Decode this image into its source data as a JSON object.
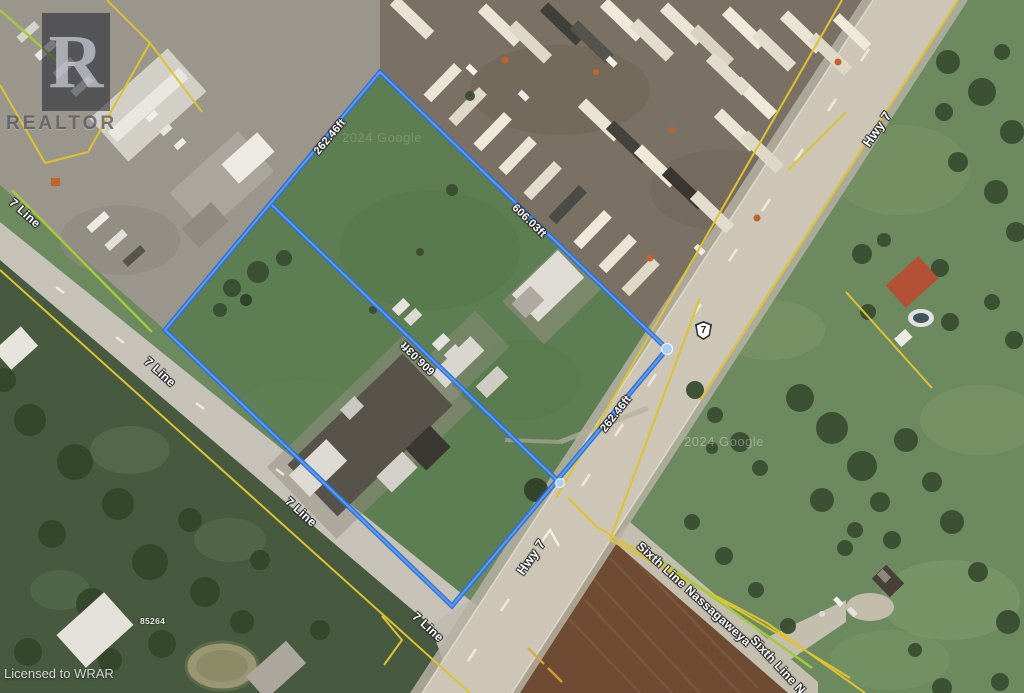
{
  "watermarks": {
    "realtor_letter": "R",
    "realtor": "REALTOR",
    "licensed": "Licensed to WRAR",
    "google": "2024 Google"
  },
  "roads": {
    "hwy7": "Hwy 7",
    "line7": "7 Line",
    "sixth_line": "Sixth Line Nassagaweya",
    "sixth_line_cut": "Sixth Line N",
    "shield": "7"
  },
  "measurements": {
    "nw_edge": "262.46ft",
    "ne_edge": "606.03ft",
    "interior": "606.03ft",
    "hwy_edge": "262.46ft"
  },
  "parcel": {
    "address": "85264"
  },
  "colors": {
    "boundary_blue": "#3B7DE2",
    "boundary_vertex": "#AECDF0",
    "parcel_yellow": "#DDC232",
    "parcel_green": "#A4C83E",
    "label_white": "#FFFFFF",
    "highway_surface": "#CDC6B6",
    "plowed_field": "#6E4B32"
  }
}
